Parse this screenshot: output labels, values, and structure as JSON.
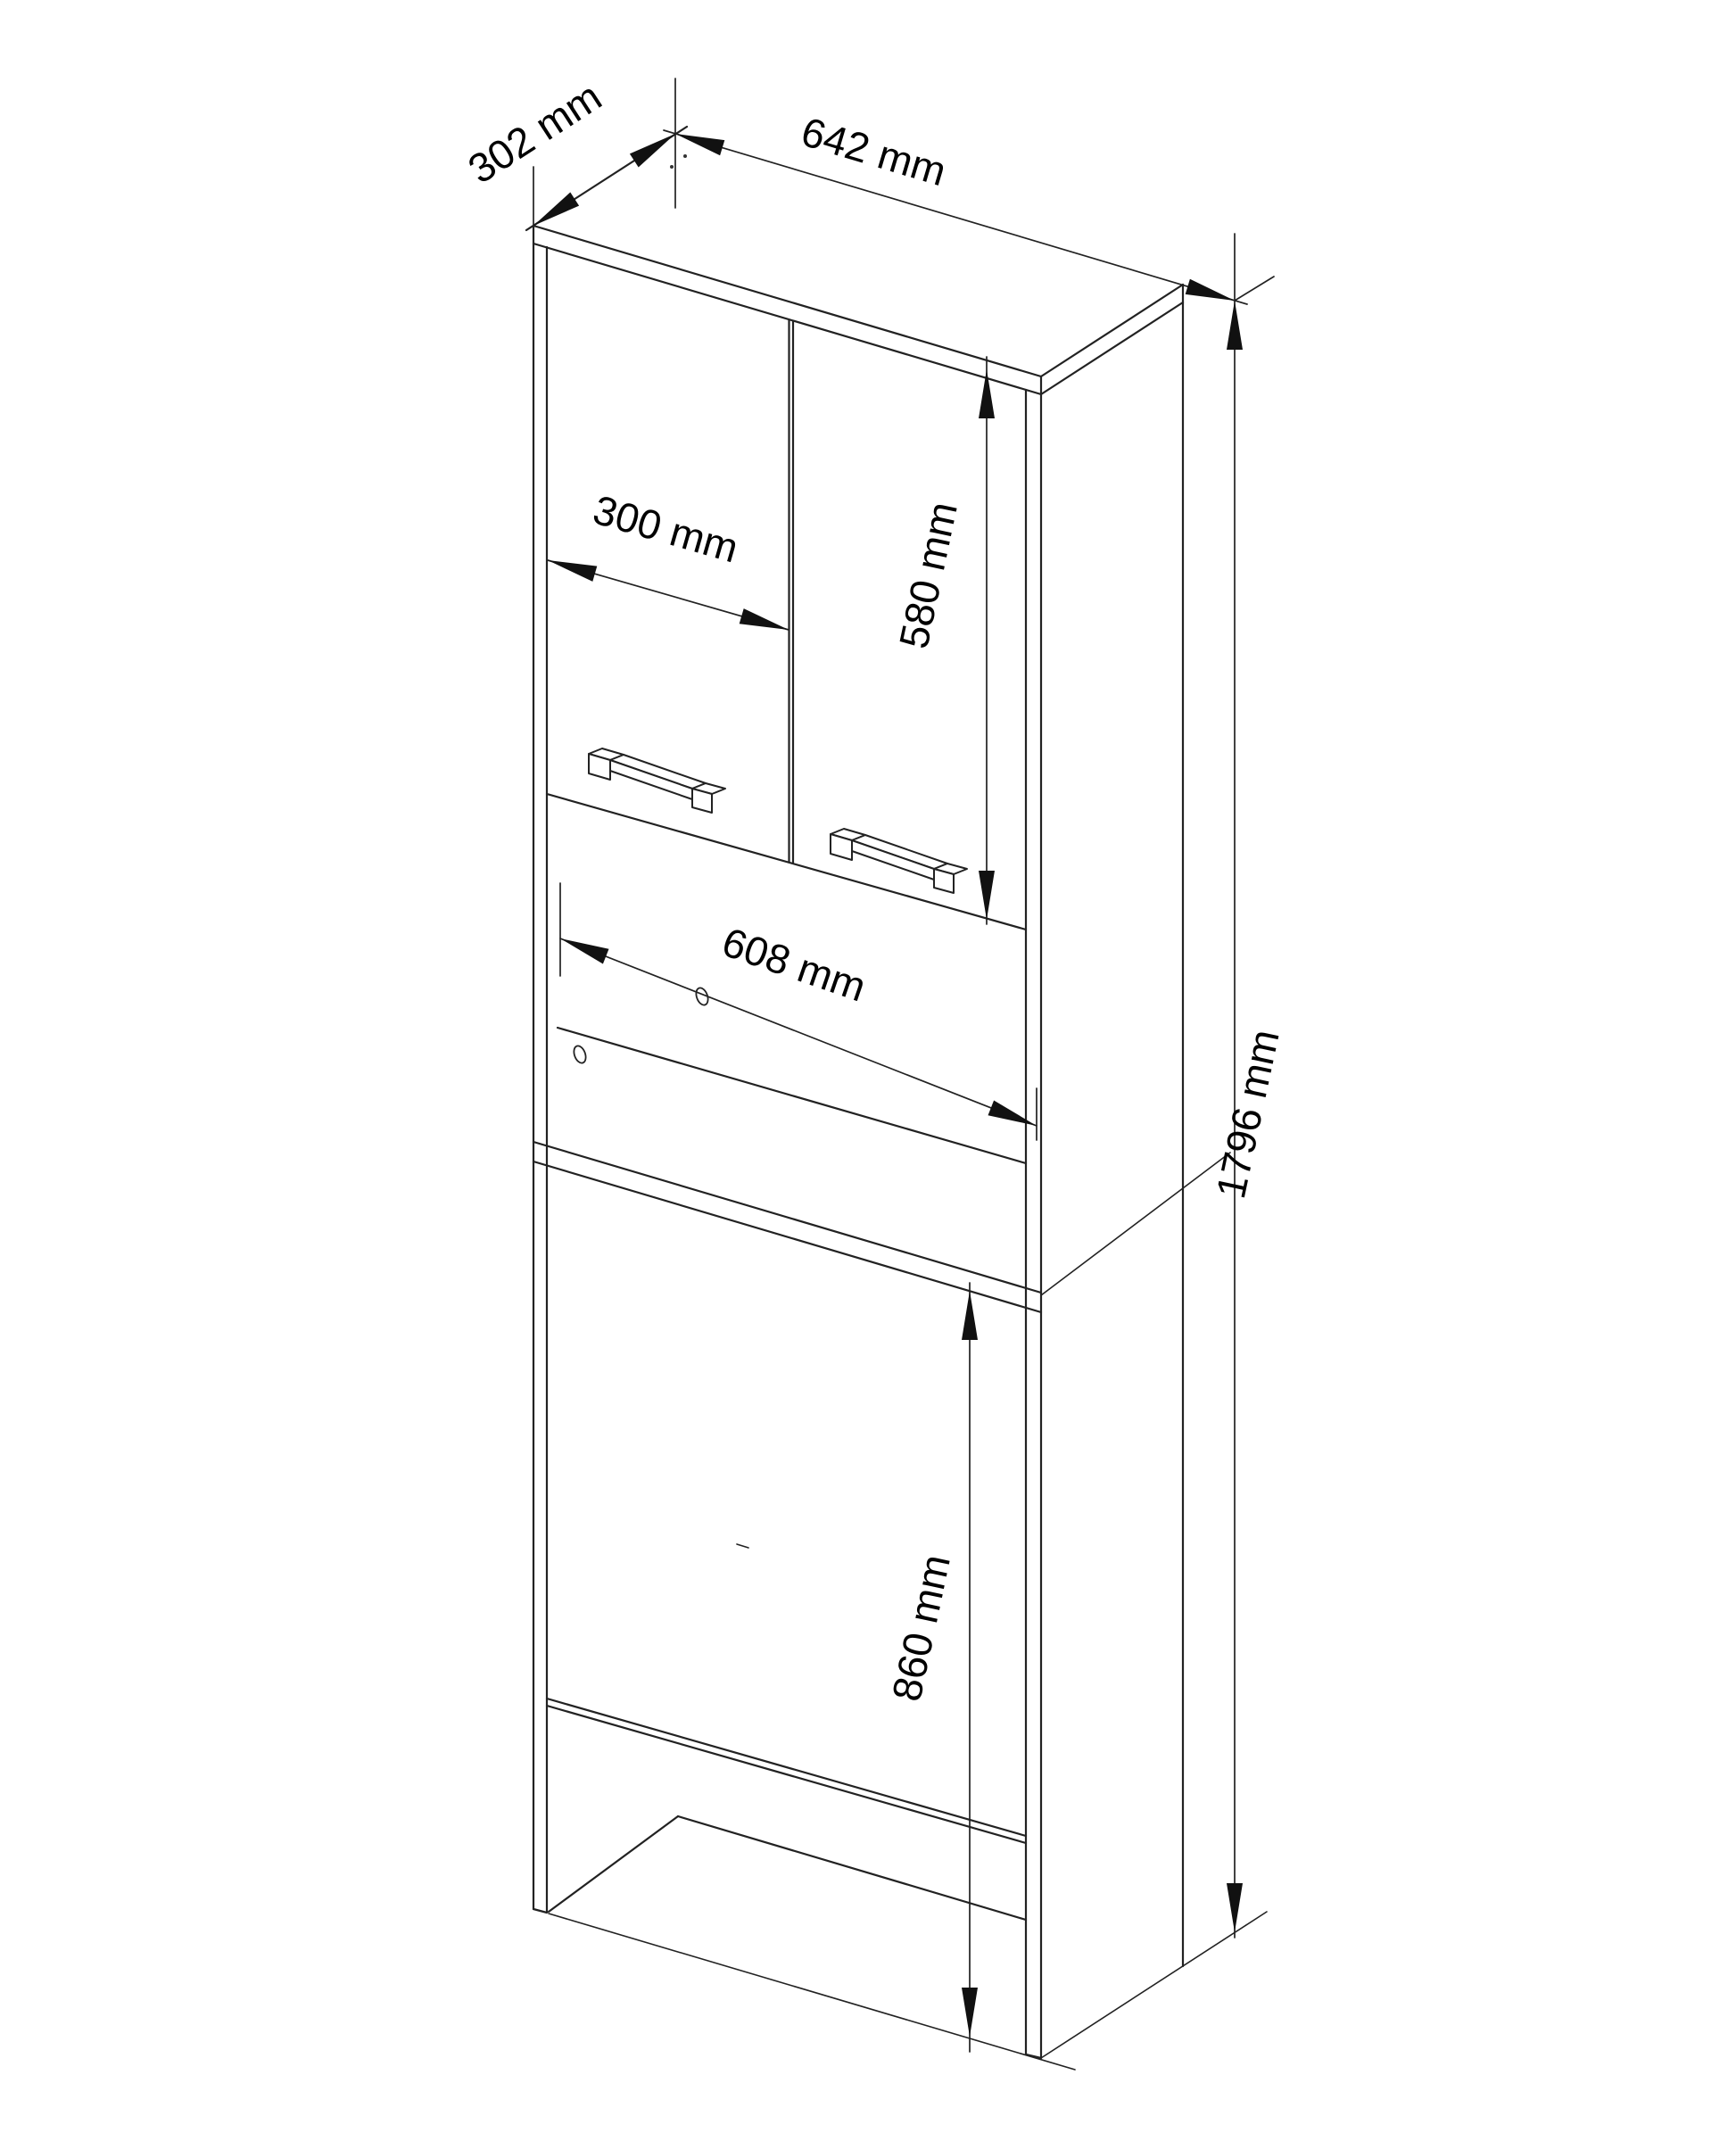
{
  "page": {
    "background": "#ffffff",
    "line_color": "#222222"
  },
  "drawing": {
    "type": "isometric-furniture-technical-drawing",
    "subject": "tall bathroom cabinet over washing machine",
    "units": "mm",
    "dimensions": {
      "depth": {
        "label": "302 mm",
        "value": 302
      },
      "width": {
        "label": "642 mm",
        "value": 642
      },
      "door_width": {
        "label": "300 mm",
        "value": 300
      },
      "door_height": {
        "label": "580 mm",
        "value": 580
      },
      "niche_width": {
        "label": "608 mm",
        "value": 608
      },
      "total_height": {
        "label": "1796 mm",
        "value": 1796
      },
      "washer_opening_height": {
        "label": "860 mm",
        "value": 860
      }
    }
  }
}
